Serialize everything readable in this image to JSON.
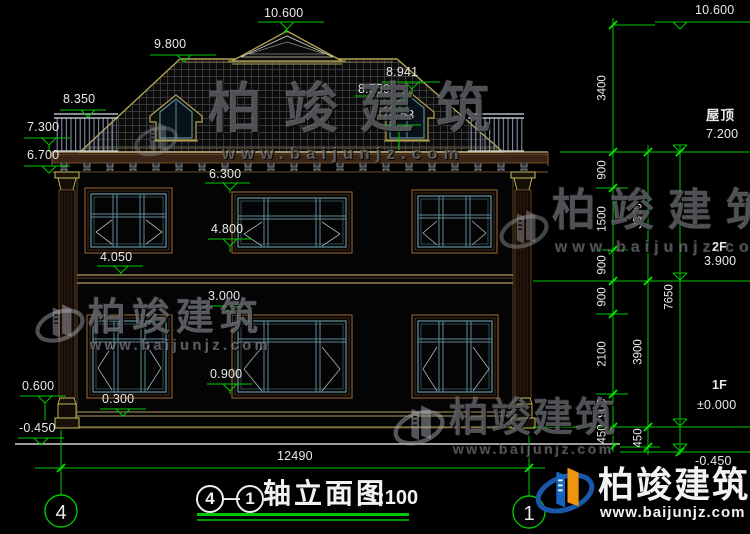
{
  "drawing": {
    "type": "architectural-elevation",
    "scale_note": "1:100"
  },
  "levels": {
    "v10600": "10.600",
    "v9800": "9.800",
    "v8941": "8.941",
    "v8559": "8.559",
    "v8350": "8.350",
    "v7753": "7.753",
    "v7300": "7.300",
    "v6700": "6.700",
    "v6300": "6.300",
    "v4800": "4.800",
    "v4050": "4.050",
    "v3000": "3.000",
    "v0900": "0.900",
    "v0600": "0.600",
    "v0300": "0.300",
    "vm0450": "-0.450"
  },
  "right": {
    "v10600": "10.600",
    "roof_label": "屋顶",
    "v7200": "7.200",
    "f2": "2F",
    "v3900": "3.900",
    "f1": "1F",
    "v0000": "±0.000",
    "vm0450": "-0.450",
    "c3400": "3400",
    "c900": "900",
    "c1500": "1500",
    "c2100": "2100",
    "c450": "450",
    "s3300": "3300",
    "s3900": "3900",
    "s450": "450",
    "total_height": "7650"
  },
  "bottom": {
    "total_width": "12490",
    "axis_left": "4",
    "axis_right": "1"
  },
  "title": {
    "axis_from": "4",
    "dash": "—",
    "axis_to": "1",
    "name": "轴立面图",
    "scale": "1:100"
  },
  "watermark": {
    "brand": "柏竣建筑",
    "site": "www.baijunjz.com"
  },
  "colors": {
    "dimension_green": "#00c800",
    "cad_text_white": "#e9e9e9",
    "roof_edge_olive": "#b3a352",
    "frame_brown": "#7a4a2a",
    "window_teal": "#5e8a96",
    "logo_blue": "#1565c0",
    "logo_orange": "#f0930f"
  }
}
